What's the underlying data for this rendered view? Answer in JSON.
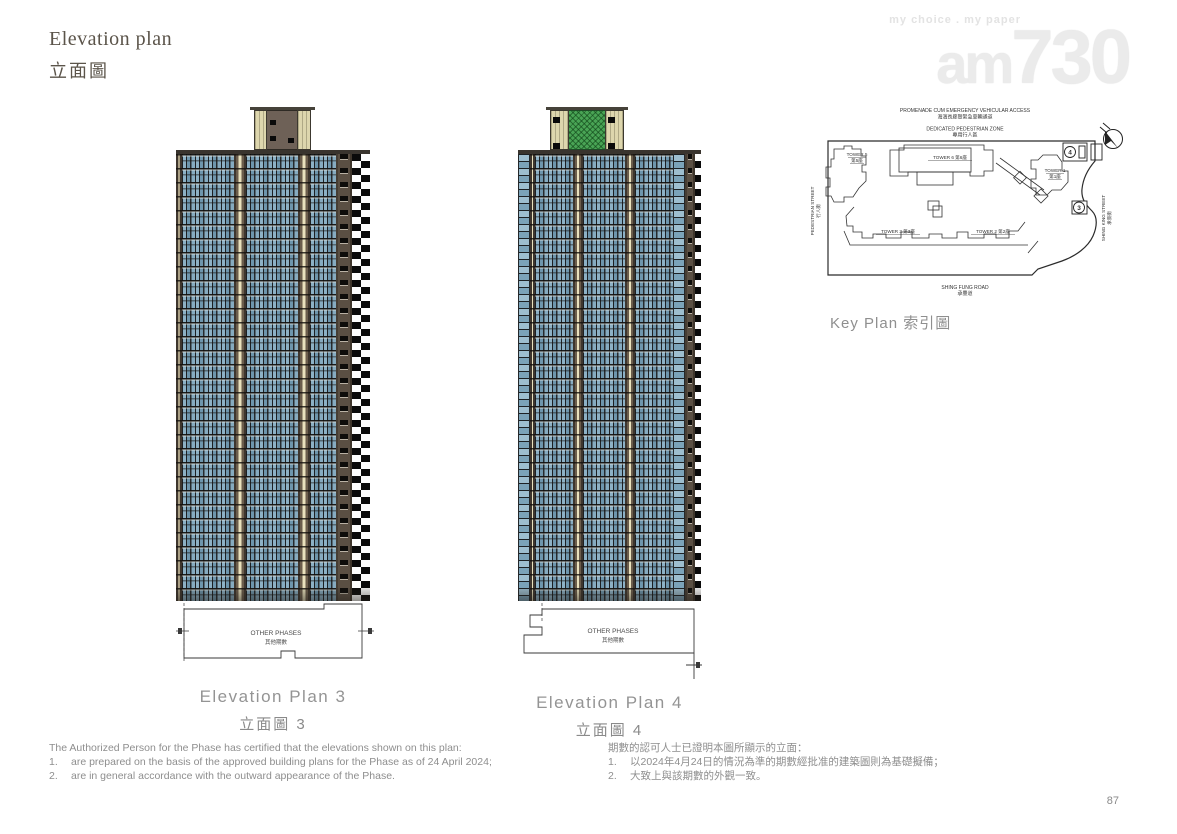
{
  "page": {
    "title_en": "Elevation plan",
    "title_zh": "立面圖",
    "page_number": "87"
  },
  "watermark": {
    "tagline": "my choice . my paper",
    "brand_am": "am",
    "brand_730": "730"
  },
  "key_plan": {
    "caption": "Key Plan 索引圖",
    "promenade_en": "PROMENADE CUM EMERGENCY VEHICULAR ACCESS",
    "promenade_zh": "海濱長廊暨緊急車輛通道",
    "pedestrian_zone_en": "DEDICATED PEDESTRIAN ZONE",
    "pedestrian_zone_zh": "專用行人區",
    "pedestrian_street_en": "PEDESTRIAN STREET",
    "pedestrian_street_zh": "行人街",
    "shing_king_street_en": "SHING KING STREET",
    "shing_king_street_zh": "承景街",
    "shing_fung_road_en": "SHING FUNG ROAD",
    "shing_fung_road_zh": "承豐道",
    "tower5_line1": "TOWER 5",
    "tower5_line2": "第5座",
    "tower6": "TOWER 6 第6座",
    "tower1_line1": "TOWER 1",
    "tower1_line2": "第1座",
    "tower3": "TOWER 3 第3座",
    "tower2": "TOWER 2 第2座",
    "marker_3": "3",
    "marker_4": "4"
  },
  "elevations": [
    {
      "caption_en": "Elevation Plan 3",
      "caption_zh": "立面圖 3",
      "other_phases_en": "OTHER PHASES",
      "other_phases_zh": "其他期數"
    },
    {
      "caption_en": "Elevation Plan 4",
      "caption_zh": "立面圖 4",
      "other_phases_en": "OTHER PHASES",
      "other_phases_zh": "其他期數"
    }
  ],
  "notes": {
    "en": {
      "intro": "The Authorized Person for the Phase has certified that the elevations shown on this plan:",
      "items": [
        {
          "num": "1.",
          "text": "are prepared on the basis of the approved building plans for the Phase as of 24 April 2024;"
        },
        {
          "num": "2.",
          "text": "are in general accordance with the outward appearance of the Phase."
        }
      ]
    },
    "zh": {
      "intro": "期數的認可人士已證明本圖所顯示的立面：",
      "items": [
        {
          "num": "1.",
          "text": "以2024年4月24日的情況為準的期數經批准的建築圖則為基礎擬備；"
        },
        {
          "num": "2.",
          "text": "大致上與該期數的外觀一致。"
        }
      ]
    }
  },
  "colors": {
    "facade_glass": "#7fa6bc",
    "facade_frame": "#1d2023",
    "pier_brown": "#6b5d4c",
    "pier_trim": "#e9e1bd",
    "roof_cream": "#ddd6ad",
    "roof_core_brown": "#6e6157",
    "roof_core_green": "#49a455",
    "plan_line": "#2b2b2b",
    "text_gray": "#8e8e8e",
    "title_brown": "#5b544a"
  }
}
